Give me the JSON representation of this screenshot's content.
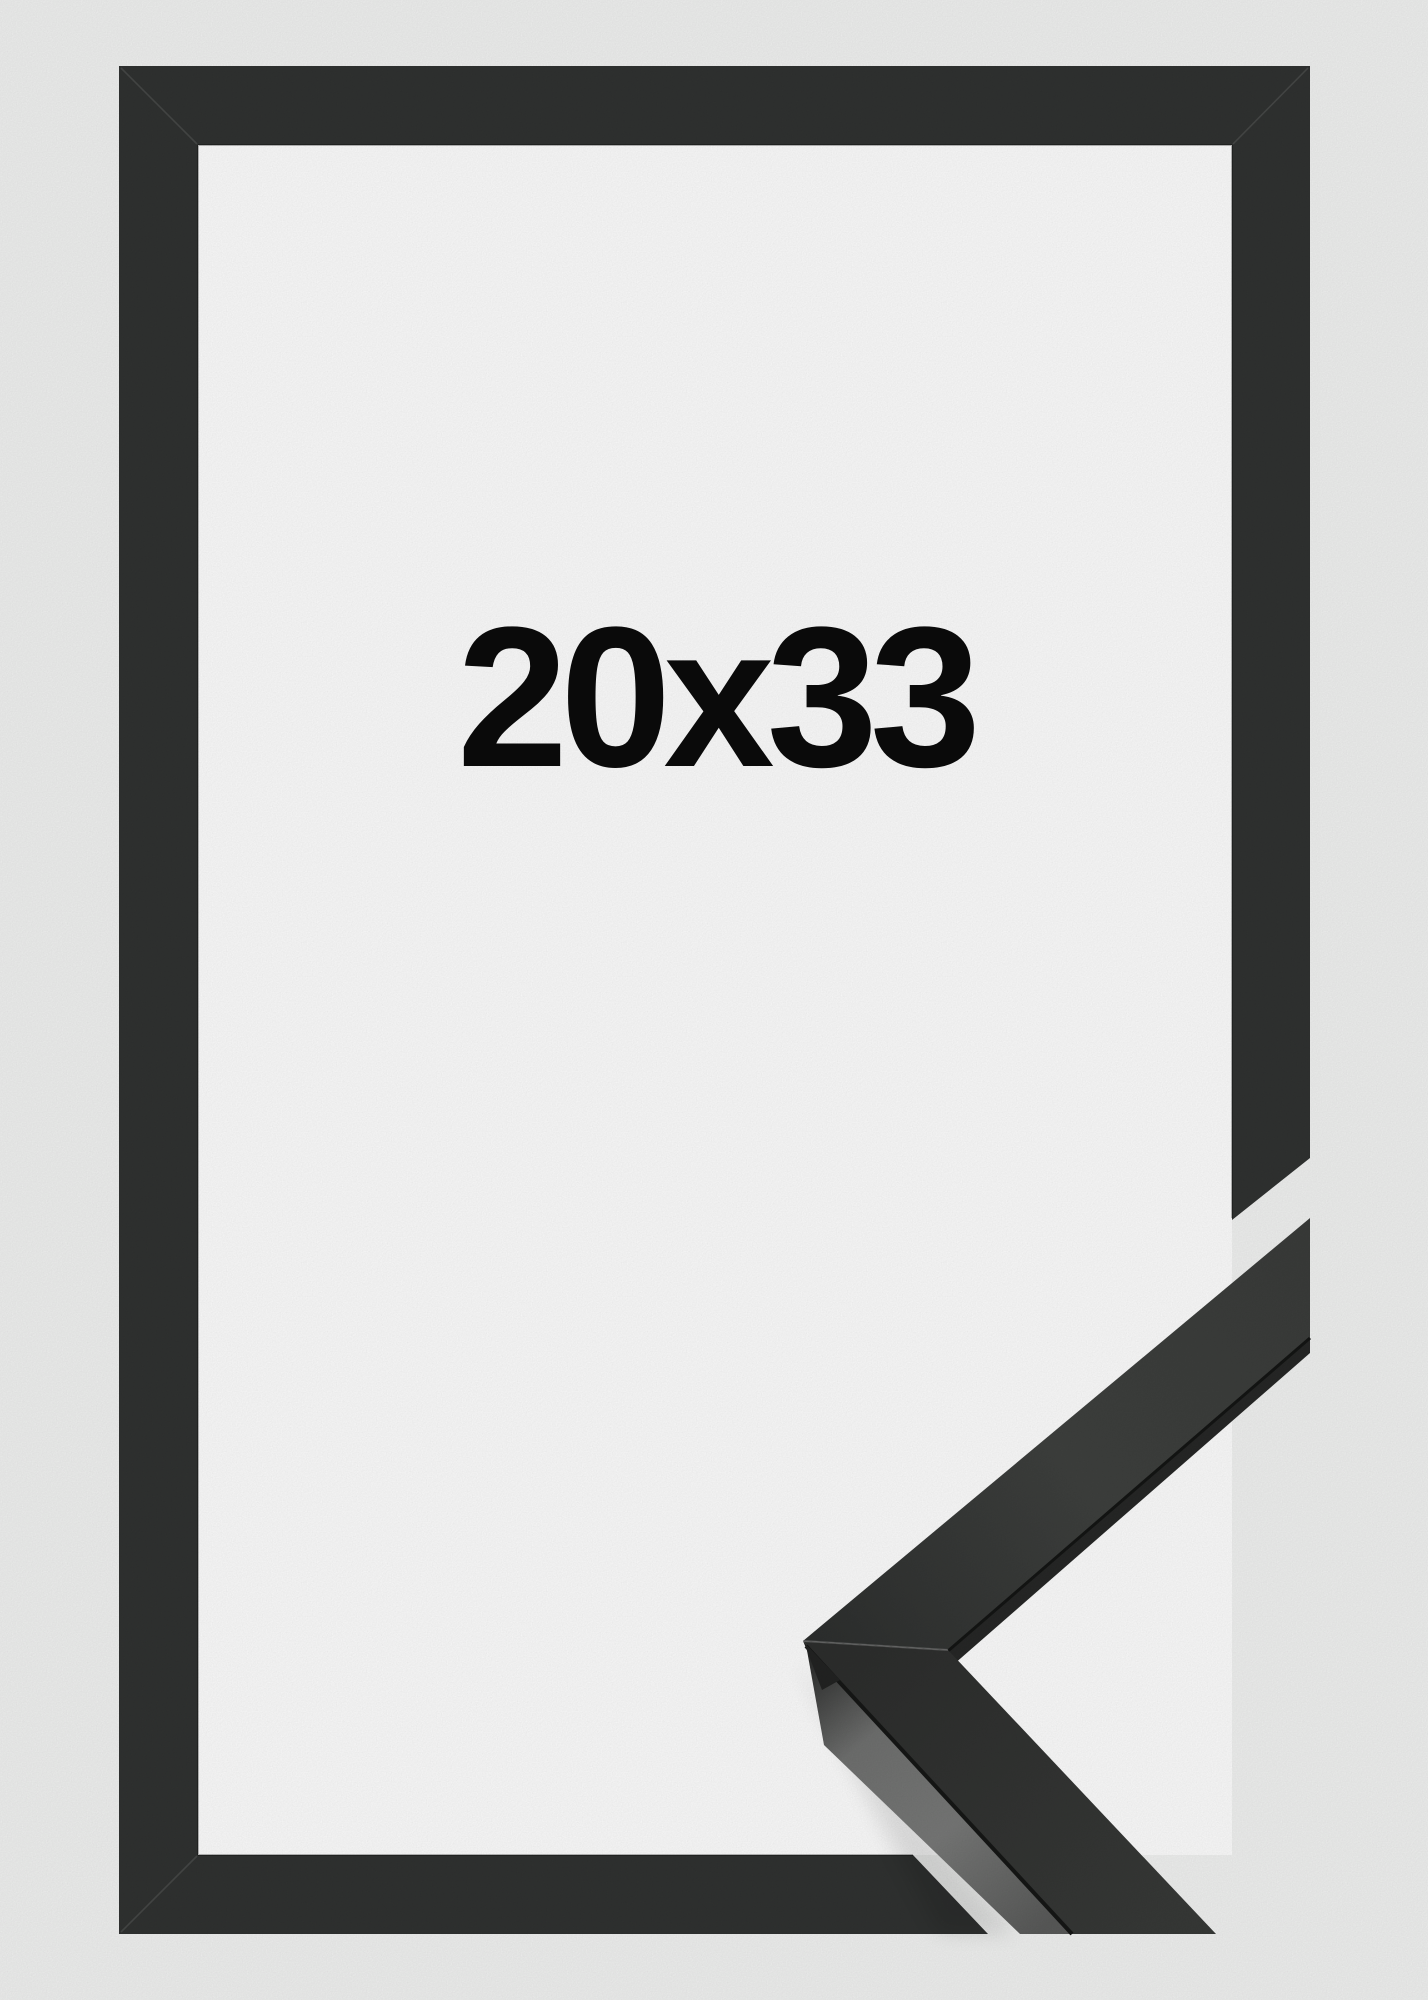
{
  "product_image": {
    "size_label": "20x33",
    "description": "Black picture frame shown front-on with a mitered corner moulding sample at the bottom right"
  },
  "colors": {
    "background": "#f0f1f0",
    "opening": "#fcfcfc",
    "frame": "#303231",
    "sample_face": "#353736",
    "sample_side": "#6e6f6e",
    "label_text": "#0a0a0a"
  }
}
